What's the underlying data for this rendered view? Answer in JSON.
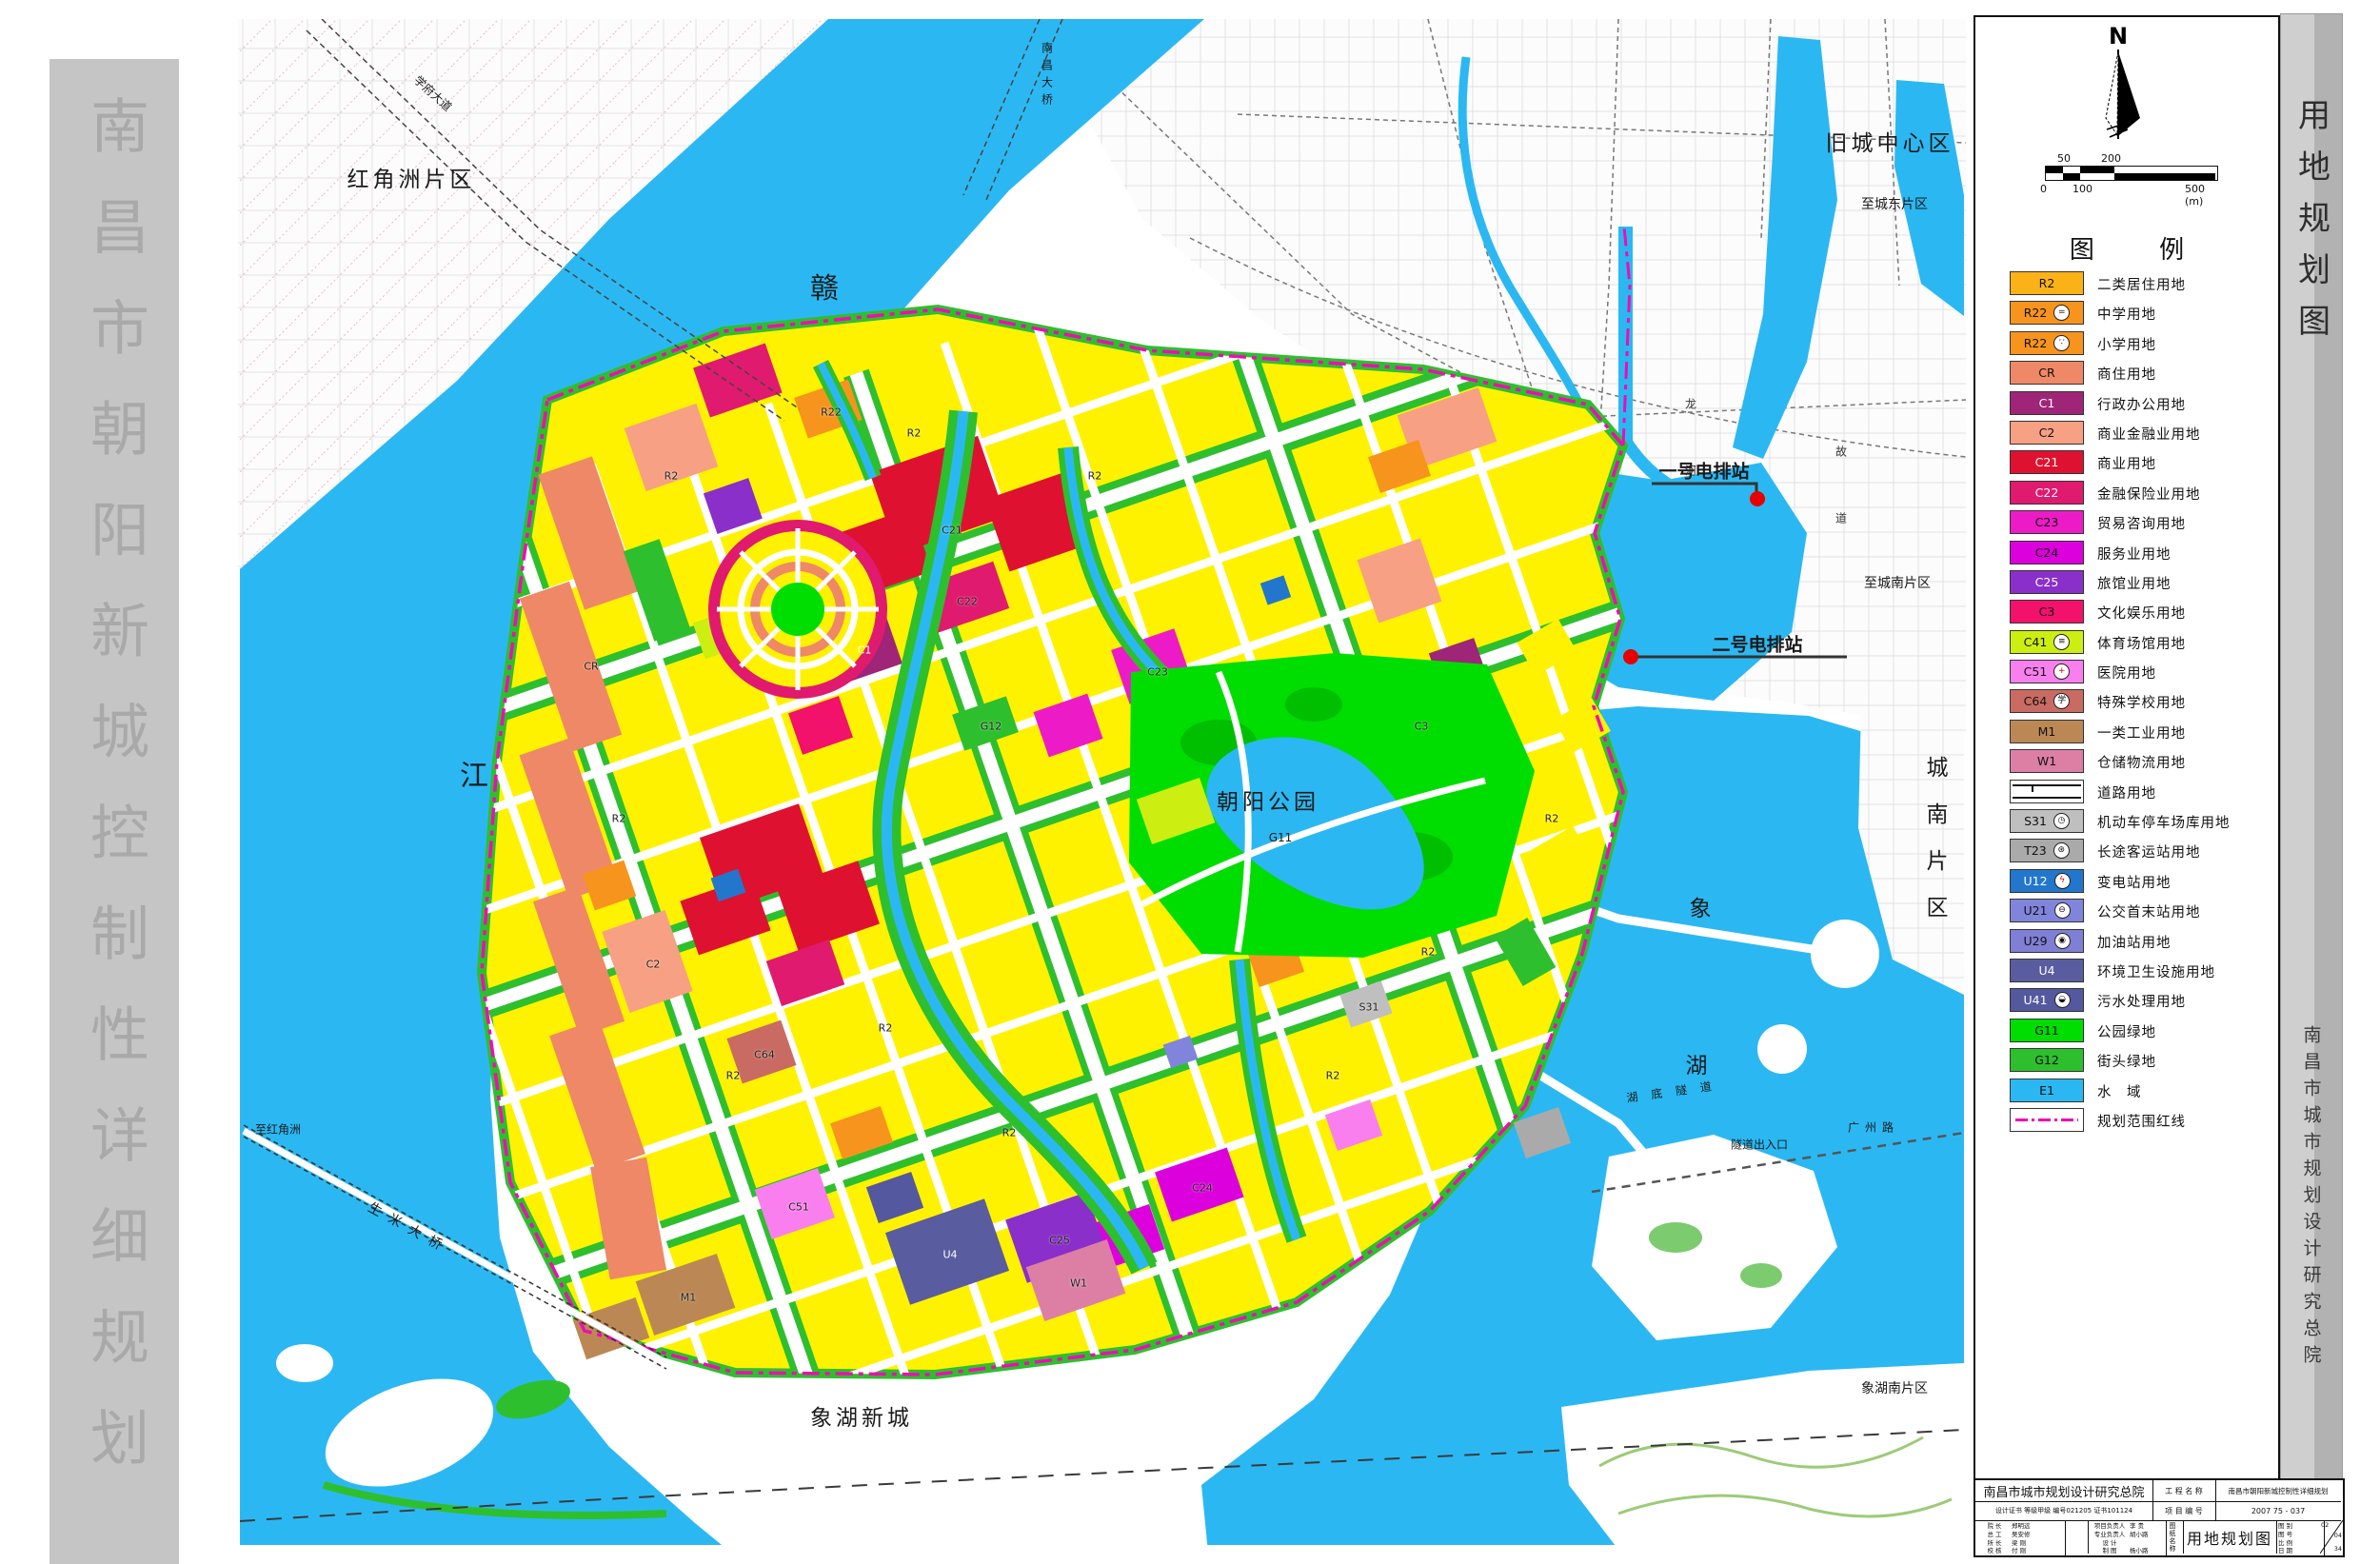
{
  "sidebar": {
    "title": "南昌市朝阳新城控制性详细规划"
  },
  "strip": {
    "title": "用地规划图",
    "institute": "南昌市城市规划设计研究总院"
  },
  "compass": {
    "n": "N"
  },
  "scalebar": {
    "top": [
      "50",
      "200"
    ],
    "bottom": [
      "0",
      "100",
      "500 (m)"
    ]
  },
  "legend": {
    "title": "图 例",
    "items": [
      {
        "code": "R2",
        "color": "#FBB217",
        "label": "二类居住用地"
      },
      {
        "code": "R22",
        "color": "#F7941D",
        "icon": "=",
        "label": "中学用地"
      },
      {
        "code": "R22",
        "color": "#F7941D",
        "icon": "∵",
        "label": "小学用地"
      },
      {
        "code": "CR",
        "color": "#EE8866",
        "label": "商住用地"
      },
      {
        "code": "C1",
        "color": "#9E2578",
        "dark": true,
        "label": "行政办公用地"
      },
      {
        "code": "C2",
        "color": "#F7A083",
        "label": "商业金融业用地"
      },
      {
        "code": "C21",
        "color": "#DE1230",
        "dark": true,
        "label": "商业用地"
      },
      {
        "code": "C22",
        "color": "#E01A6E",
        "dark": true,
        "label": "金融保险业用地"
      },
      {
        "code": "C23",
        "color": "#ED1BC7",
        "label": "贸易咨询用地"
      },
      {
        "code": "C24",
        "color": "#DC00DC",
        "label": "服务业用地"
      },
      {
        "code": "C25",
        "color": "#8A2FC9",
        "dark": true,
        "label": "旅馆业用地"
      },
      {
        "code": "C3",
        "color": "#F2116B",
        "label": "文化娱乐用地"
      },
      {
        "code": "C41",
        "color": "#CCEE11",
        "icon": "≡",
        "label": "体育场馆用地"
      },
      {
        "code": "C51",
        "color": "#F97FEE",
        "icon": "+",
        "iconColor": "#CC0000",
        "label": "医院用地"
      },
      {
        "code": "C64",
        "color": "#C96B62",
        "icon": "学",
        "label": "特殊学校用地"
      },
      {
        "code": "M1",
        "color": "#BB8855",
        "label": "一类工业用地"
      },
      {
        "code": "W1",
        "color": "#DD7FA5",
        "label": "仓储物流用地"
      },
      {
        "type": "road",
        "label": "道路用地"
      },
      {
        "code": "S31",
        "color": "#BFBFBF",
        "icon": "◷",
        "label": "机动车停车场库用地"
      },
      {
        "code": "T23",
        "color": "#AAAAAA",
        "icon": "⊛",
        "label": "长途客运站用地"
      },
      {
        "code": "U12",
        "color": "#2277CC",
        "dark": true,
        "icon": "ϟ",
        "iconColor": "#DD0000",
        "label": "变电站用地"
      },
      {
        "code": "U21",
        "color": "#8085DB",
        "icon": "⊖",
        "label": "公交首末站用地"
      },
      {
        "code": "U29",
        "color": "#7F7FD6",
        "icon": "◉",
        "label": "加油站用地"
      },
      {
        "code": "U4",
        "color": "#5A5CA0",
        "dark": true,
        "label": "环境卫生设施用地"
      },
      {
        "code": "U41",
        "color": "#54589E",
        "dark": true,
        "icon": "◒",
        "label": "污水处理用地"
      },
      {
        "code": "G11",
        "color": "#00DD00",
        "label": "公园绿地"
      },
      {
        "code": "G12",
        "color": "#2EBF2E",
        "label": "街头绿地"
      },
      {
        "code": "E1",
        "color": "#2BB8F2",
        "label": "水　域"
      },
      {
        "type": "boundary",
        "label": "规划范围红线"
      }
    ]
  },
  "map": {
    "labels": {
      "hongjiaozhou": "红角洲片区",
      "xuefu": "学府大道",
      "nanchang_bridge": "南昌大桥",
      "gan": "赣",
      "jiang": "江",
      "old_city": "旧城中心区",
      "to_east": "至城东片区",
      "drain1": "一号电排站",
      "drain2": "二号电排站",
      "longhe": "龙河",
      "gudao": "故道",
      "park": "朝阳公园",
      "park_code": "G11",
      "chengnan": "城南片区",
      "xiang": "象",
      "hu": "湖",
      "tunnel": "湖底隧道",
      "tunnel_exit": "隧道出入口",
      "to_south": "至城南片区",
      "guangzhou": "广州路",
      "xianghu_south": "象湖南片区",
      "xianghu_new": "象湖新城",
      "to_hjz": "至红角洲",
      "shengmi": "生米大桥"
    },
    "codes": [
      "R2",
      "R2",
      "R2",
      "R2",
      "R2",
      "R2",
      "R2",
      "R2",
      "R2",
      "R2",
      "C21",
      "C22",
      "C23",
      "C24",
      "C25",
      "C1",
      "CR",
      "C2",
      "C3",
      "G12",
      "M1",
      "W1",
      "U4",
      "S31",
      "R22",
      "C51",
      "C64"
    ]
  },
  "titleblock": {
    "institute": "南昌市城市规划设计研究总院",
    "project_label": "工 程 名 称",
    "project_name": "南昌市朝阳新城控制性详细规划",
    "cert": "设计证书 等级甲级 编号021205 证书101124",
    "project_no_label": "项 目 编 号",
    "project_no": "2007 75 - 037",
    "drawing_name_label": "图纸名称",
    "drawing_name": "用地规划图",
    "sign_rows_a": [
      [
        "院 长",
        "郑明远"
      ],
      [
        "总 工",
        "吴安修"
      ],
      [
        "所 长",
        "梁 刚"
      ],
      [
        "校 核",
        "付 刚"
      ]
    ],
    "sign_rows_b": [
      [
        "项目负责人",
        "李 贵"
      ],
      [
        "专业负责人",
        "胡小路"
      ],
      [
        "设 计",
        ""
      ],
      [
        "制 图",
        "杨小路"
      ]
    ],
    "meta_labels": [
      "图 别",
      "图 号",
      "比 例",
      "日 期"
    ],
    "page_nums": [
      "02",
      "04",
      "34"
    ]
  }
}
